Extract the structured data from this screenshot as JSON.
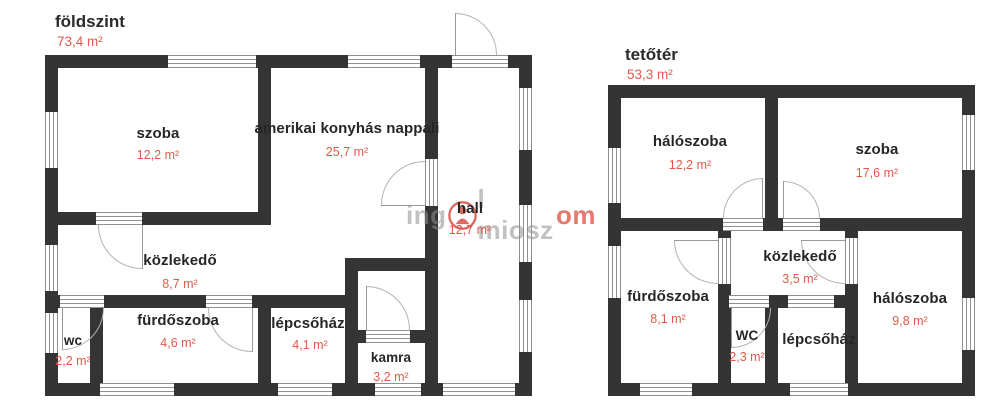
{
  "colors": {
    "wall": "#343434",
    "area_red": "#e05a4b",
    "label": "#262626"
  },
  "watermark": {
    "gray_left": "ing",
    "gray_mid": "l miosz",
    "red_suffix": "om",
    "logo": "ingatlan-logo"
  },
  "floors": [
    {
      "title": "földszint",
      "area": "73,4 m²",
      "rooms": [
        {
          "name": "szoba",
          "area": "12,2 m²"
        },
        {
          "name": "amerikai konyhás nappali",
          "area": "25,7 m²"
        },
        {
          "name": "hall",
          "area": "12,7 m²"
        },
        {
          "name": "közlekedő",
          "area": "8,7 m²"
        },
        {
          "name": "wc",
          "area": "2,2 m²"
        },
        {
          "name": "fürdőszoba",
          "area": "4,6 m²"
        },
        {
          "name": "lépcsőház",
          "area": "4,1 m²"
        },
        {
          "name": "kamra",
          "area": "3,2 m²"
        }
      ]
    },
    {
      "title": "tetőtér",
      "area": "53,3 m²",
      "rooms": [
        {
          "name": "hálószoba",
          "area": "12,2 m²"
        },
        {
          "name": "szoba",
          "area": "17,6 m²"
        },
        {
          "name": "közlekedő",
          "area": "3,5 m²"
        },
        {
          "name": "fürdőszoba",
          "area": "8,1 m²"
        },
        {
          "name": "WC",
          "area": "2,3 m²"
        },
        {
          "name": "lépcsőház",
          "area": ""
        },
        {
          "name": "hálószoba",
          "area": "9,8 m²"
        }
      ]
    }
  ]
}
